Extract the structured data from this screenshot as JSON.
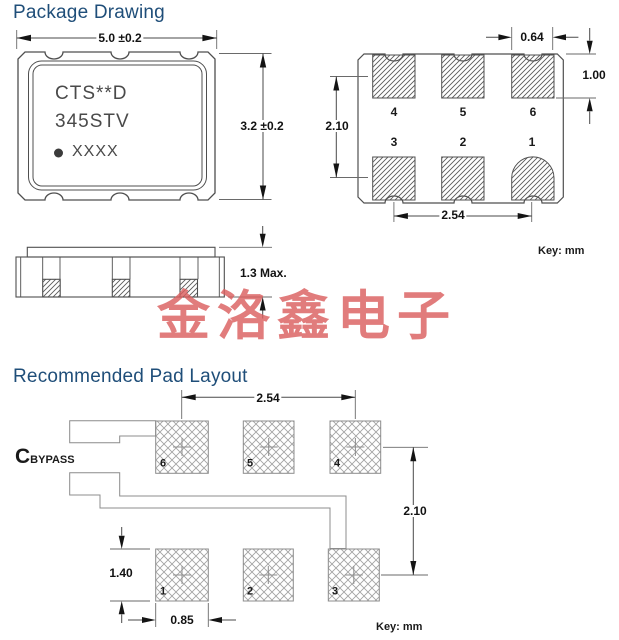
{
  "colors": {
    "accent_blue": "#1f4e79",
    "line_dark": "#4f4f4f",
    "line_light": "#8c8c8c",
    "watermark_red": "#db5f5f"
  },
  "package_drawing": {
    "title": "Package Drawing",
    "top_view": {
      "width_dim": "5.0 ±0.2",
      "height_dim": "3.2 ±0.2",
      "marking_line1": "CTS**D",
      "marking_line2": "345STV",
      "marking_line3": "XXXX"
    },
    "bottom_view": {
      "pad_width_dim": "0.64",
      "pad_height_dim": "1.00",
      "row_pitch_dim": "2.10",
      "col_pitch_dim": "2.54",
      "pads_top_row": [
        "4",
        "5",
        "6"
      ],
      "pads_bottom_row": [
        "3",
        "2",
        "1"
      ],
      "key": "Key:  mm"
    },
    "side_view": {
      "height_dim": "1.3 Max."
    }
  },
  "watermark": {
    "text": "金洛鑫电子"
  },
  "pad_layout": {
    "title": "Recommended Pad Layout",
    "bypass_label_main": "C",
    "bypass_label_sub": "BYPASS",
    "col_pitch_dim": "2.54",
    "row_pitch_dim": "2.10",
    "pad_height_dim": "1.40",
    "pad_width_dim": "0.85",
    "pads_top_row": [
      "6",
      "5",
      "4"
    ],
    "pads_bottom_row": [
      "1",
      "2",
      "3"
    ],
    "key": "Key:  mm"
  }
}
